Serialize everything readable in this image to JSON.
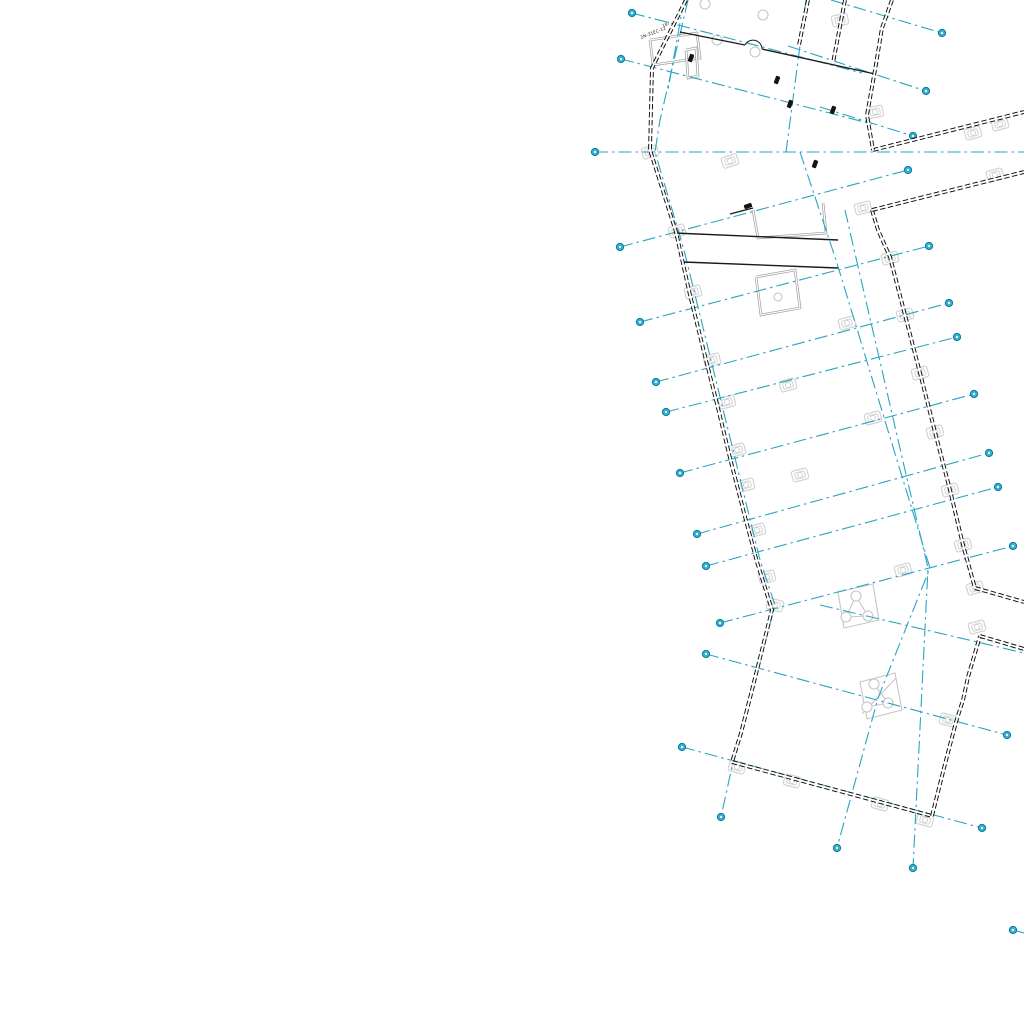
{
  "drawing": {
    "title": "floor-plan-fragment",
    "canvas": {
      "width": 1024,
      "height": 1024,
      "background": "#ffffff"
    },
    "palette": {
      "grid_line": "#2aa4c2",
      "marker_fill": "#3ab4d2",
      "marker_stroke": "#0d7f9f",
      "wall": "#0c0c0c",
      "interior_wall": "#1a1a1a",
      "partition_gray": "#9c9c9c",
      "column_gray": "#d4d4d4",
      "glyph_gray": "#c6c6c6",
      "annotation": "#2b2b2b"
    },
    "annotations": [
      {
        "text": "2N-31EC-12",
        "x": 641,
        "y": 39,
        "rot": -21,
        "size": 4.5
      },
      {
        "text": "187",
        "x": 663,
        "y": 27,
        "rot": -21,
        "size": 4
      }
    ],
    "exterior_walls": [
      {
        "name": "left-wall",
        "points": [
          [
            686,
            0
          ],
          [
            668,
            36
          ],
          [
            652,
            68
          ],
          [
            650,
            150
          ],
          [
            676,
            232
          ],
          [
            690,
            295
          ],
          [
            703,
            348
          ],
          [
            718,
            408
          ],
          [
            731,
            462
          ],
          [
            744,
            513
          ],
          [
            757,
            562
          ],
          [
            772,
            610
          ],
          [
            762,
            650
          ],
          [
            751,
            694
          ],
          [
            741,
            733
          ],
          [
            732,
            762
          ]
        ]
      },
      {
        "name": "bottom-wall",
        "points": [
          [
            732,
            762
          ],
          [
            932,
            816
          ]
        ]
      },
      {
        "name": "lower-right-wall",
        "points": [
          [
            932,
            816
          ],
          [
            944,
            768
          ],
          [
            956,
            722
          ],
          [
            963,
            700
          ],
          [
            968,
            677
          ],
          [
            980,
            636
          ]
        ]
      },
      {
        "name": "notch-lower-wall",
        "points": [
          [
            980,
            636
          ],
          [
            1024,
            649
          ]
        ]
      },
      {
        "name": "notch-upper-wall",
        "points": [
          [
            975,
            588
          ],
          [
            1024,
            602
          ]
        ]
      },
      {
        "name": "mid-right-wall",
        "points": [
          [
            872,
            210
          ],
          [
            878,
            230
          ],
          [
            890,
            257
          ],
          [
            905,
            315
          ],
          [
            920,
            373
          ],
          [
            935,
            432
          ],
          [
            950,
            490
          ],
          [
            963,
            545
          ],
          [
            975,
            588
          ]
        ]
      },
      {
        "name": "wing-lower-wall",
        "points": [
          [
            872,
            210
          ],
          [
            1024,
            172
          ]
        ]
      },
      {
        "name": "wing-upper-wall",
        "points": [
          [
            873,
            150
          ],
          [
            1024,
            112
          ]
        ]
      },
      {
        "name": "top-right-wall",
        "points": [
          [
            892,
            0
          ],
          [
            882,
            28
          ],
          [
            875,
            70
          ],
          [
            867,
            115
          ],
          [
            873,
            150
          ]
        ]
      },
      {
        "name": "top-fragment-1",
        "points": [
          [
            845,
            0
          ],
          [
            833,
            63
          ]
        ]
      },
      {
        "name": "top-fragment-2",
        "points": [
          [
            808,
            0
          ],
          [
            799,
            45
          ]
        ]
      }
    ],
    "interior_walls": [
      {
        "name": "top-room-wall-a",
        "points": [
          [
            680,
            32
          ],
          [
            745,
            45
          ]
        ]
      },
      {
        "name": "top-room-wall-b",
        "points": [
          [
            762,
            49
          ],
          [
            875,
            74
          ]
        ]
      },
      {
        "name": "corridor-wall-1",
        "points": [
          [
            674,
            233
          ],
          [
            838,
            240
          ]
        ]
      },
      {
        "name": "corridor-wall-2",
        "points": [
          [
            683,
            262
          ],
          [
            838,
            268
          ]
        ]
      },
      {
        "name": "step-wall-stub",
        "points": [
          [
            730,
            214
          ],
          [
            753,
            208
          ]
        ]
      }
    ],
    "door_arc": {
      "cx": 753,
      "cy": 47,
      "r": 9,
      "from": [
        745,
        45
      ],
      "to": [
        762,
        49
      ]
    },
    "gray_partitions": [
      {
        "name": "top-left-room",
        "points": [
          [
            650,
            40
          ],
          [
            697,
            33
          ],
          [
            700,
            58
          ],
          [
            653,
            65
          ],
          [
            650,
            40
          ]
        ]
      },
      {
        "name": "top-slim-closet",
        "points": [
          [
            686,
            50
          ],
          [
            696,
            48
          ],
          [
            698,
            76
          ],
          [
            688,
            78
          ],
          [
            686,
            50
          ]
        ]
      },
      {
        "name": "step-recess",
        "points": [
          [
            753,
            210
          ],
          [
            758,
            238
          ],
          [
            826,
            233
          ],
          [
            823,
            203
          ]
        ]
      },
      {
        "name": "elevator-shaft",
        "points": [
          [
            756,
            277
          ],
          [
            795,
            270
          ],
          [
            800,
            308
          ],
          [
            761,
            315
          ],
          [
            756,
            277
          ]
        ]
      }
    ],
    "grid_lines": [
      {
        "name": "H1",
        "x1": 595,
        "y1": 152,
        "x2": 1024,
        "y2": 152,
        "m1": true,
        "m2": false
      },
      {
        "name": "T1",
        "x1": 632,
        "y1": 13,
        "x2": 862,
        "y2": 73,
        "m1": true,
        "m2": false
      },
      {
        "name": "T2",
        "x1": 621,
        "y1": 59,
        "x2": 872,
        "y2": 124,
        "m1": true,
        "m2": false
      },
      {
        "name": "T3",
        "x1": 831,
        "y1": 0,
        "x2": 942,
        "y2": 33,
        "m1": false,
        "m2": true
      },
      {
        "name": "T4",
        "x1": 788,
        "y1": 46,
        "x2": 926,
        "y2": 91,
        "m1": false,
        "m2": true
      },
      {
        "name": "T5",
        "x1": 820,
        "y1": 107,
        "x2": 913,
        "y2": 136,
        "m1": false,
        "m2": true
      },
      {
        "name": "M1",
        "x1": 620,
        "y1": 247,
        "x2": 908,
        "y2": 170,
        "m1": true,
        "m2": true
      },
      {
        "name": "M2",
        "x1": 640,
        "y1": 322,
        "x2": 929,
        "y2": 246,
        "m1": true,
        "m2": true
      },
      {
        "name": "M3",
        "x1": 656,
        "y1": 382,
        "x2": 949,
        "y2": 303,
        "m1": true,
        "m2": true
      },
      {
        "name": "M4",
        "x1": 666,
        "y1": 412,
        "x2": 957,
        "y2": 337,
        "m1": true,
        "m2": true
      },
      {
        "name": "M5",
        "x1": 680,
        "y1": 473,
        "x2": 974,
        "y2": 394,
        "m1": true,
        "m2": true
      },
      {
        "name": "M6",
        "x1": 697,
        "y1": 534,
        "x2": 989,
        "y2": 453,
        "m1": true,
        "m2": true
      },
      {
        "name": "M7",
        "x1": 706,
        "y1": 566,
        "x2": 998,
        "y2": 487,
        "m1": true,
        "m2": true
      },
      {
        "name": "M8",
        "x1": 720,
        "y1": 623,
        "x2": 1013,
        "y2": 546,
        "m1": true,
        "m2": true
      },
      {
        "name": "M9",
        "x1": 820,
        "y1": 605,
        "x2": 1024,
        "y2": 653,
        "m1": false,
        "m2": false
      },
      {
        "name": "B1",
        "x1": 706,
        "y1": 654,
        "x2": 1007,
        "y2": 735,
        "m1": true,
        "m2": true
      },
      {
        "name": "B2",
        "x1": 682,
        "y1": 747,
        "x2": 982,
        "y2": 828,
        "m1": true,
        "m2": true
      },
      {
        "name": "B3",
        "x1": 1013,
        "y1": 930,
        "x2": 1024,
        "y2": 933,
        "m1": true,
        "m2": false
      }
    ],
    "grid_polylines": [
      {
        "name": "P1",
        "points": [
          [
            688,
            0
          ],
          [
            660,
            120
          ],
          [
            655,
            152
          ],
          [
            684,
            250
          ],
          [
            760,
            560
          ],
          [
            775,
            605
          ],
          [
            733,
            762
          ],
          [
            721,
            817
          ]
        ],
        "marker_end": true
      },
      {
        "name": "P2a",
        "points": [
          [
            806,
            0
          ],
          [
            786,
            152
          ]
        ],
        "marker_end": false
      },
      {
        "name": "P2b",
        "points": [
          [
            800,
            152
          ],
          [
            836,
            260
          ],
          [
            900,
            470
          ],
          [
            930,
            568
          ],
          [
            878,
            698
          ],
          [
            837,
            848
          ]
        ],
        "marker_end": true
      },
      {
        "name": "P3",
        "points": [
          [
            845,
            210
          ],
          [
            905,
            470
          ],
          [
            928,
            568
          ],
          [
            913,
            868
          ]
        ],
        "marker_end": true
      },
      {
        "name": "P4",
        "points": [
          [
            684,
            0
          ],
          [
            668,
            90
          ]
        ],
        "marker_end": false
      }
    ],
    "columns": [
      [
        650,
        152,
        -15
      ],
      [
        730,
        161,
        -18
      ],
      [
        840,
        20,
        -12
      ],
      [
        875,
        112,
        -12
      ],
      [
        863,
        208,
        -14
      ],
      [
        973,
        133,
        -15
      ],
      [
        1000,
        124,
        -15
      ],
      [
        995,
        175,
        -15
      ],
      [
        677,
        231,
        -15
      ],
      [
        693,
        292,
        -15
      ],
      [
        712,
        360,
        -15
      ],
      [
        727,
        402,
        -15
      ],
      [
        737,
        450,
        -15
      ],
      [
        746,
        485,
        -15
      ],
      [
        757,
        530,
        -15
      ],
      [
        767,
        577,
        -15
      ],
      [
        890,
        258,
        -15
      ],
      [
        905,
        315,
        -15
      ],
      [
        920,
        373,
        -15
      ],
      [
        935,
        432,
        -15
      ],
      [
        950,
        490,
        -15
      ],
      [
        963,
        545,
        -15
      ],
      [
        975,
        588,
        -15
      ],
      [
        977,
        627,
        -15
      ],
      [
        847,
        323,
        -15
      ],
      [
        873,
        418,
        -15
      ],
      [
        788,
        385,
        -15
      ],
      [
        800,
        475,
        -15
      ],
      [
        903,
        570,
        -15
      ],
      [
        737,
        767,
        15
      ],
      [
        792,
        781,
        15
      ],
      [
        880,
        804,
        15
      ],
      [
        925,
        820,
        15
      ],
      [
        948,
        720,
        15
      ],
      [
        775,
        605,
        15
      ]
    ],
    "special_glyphs": [
      {
        "name": "stair-triangle-glyph",
        "quad": [
          [
            838,
            592
          ],
          [
            873,
            584
          ],
          [
            879,
            620
          ],
          [
            844,
            628
          ]
        ],
        "circles": [
          [
            856,
            596
          ],
          [
            846,
            617
          ],
          [
            868,
            616
          ]
        ],
        "lines": [
          [
            [
              856,
              596
            ],
            [
              846,
              617
            ]
          ],
          [
            [
              846,
              617
            ],
            [
              868,
              616
            ]
          ],
          [
            [
              868,
              616
            ],
            [
              856,
              596
            ]
          ]
        ]
      },
      {
        "name": "stair-lower-glyph",
        "quad": [
          [
            860,
            682
          ],
          [
            895,
            673
          ],
          [
            902,
            710
          ],
          [
            867,
            719
          ]
        ],
        "circles": [
          [
            874,
            684
          ],
          [
            867,
            707
          ],
          [
            888,
            703
          ]
        ],
        "lines": [
          [
            [
              874,
              684
            ],
            [
              888,
              703
            ]
          ],
          [
            [
              867,
              707
            ],
            [
              888,
              703
            ]
          ],
          [
            [
              862,
              714
            ],
            [
              896,
              678
            ]
          ]
        ]
      }
    ],
    "gray_circles": [
      [
        705,
        4,
        5
      ],
      [
        763,
        15,
        5
      ],
      [
        717,
        40,
        5
      ],
      [
        755,
        52,
        5
      ],
      [
        778,
        297,
        4
      ]
    ],
    "label_blobs": [
      [
        691,
        58,
        -70
      ],
      [
        777,
        80,
        -70
      ],
      [
        790,
        104,
        -70
      ],
      [
        815,
        164,
        -70
      ],
      [
        748,
        206,
        -20
      ],
      [
        833,
        110,
        -70
      ]
    ]
  }
}
